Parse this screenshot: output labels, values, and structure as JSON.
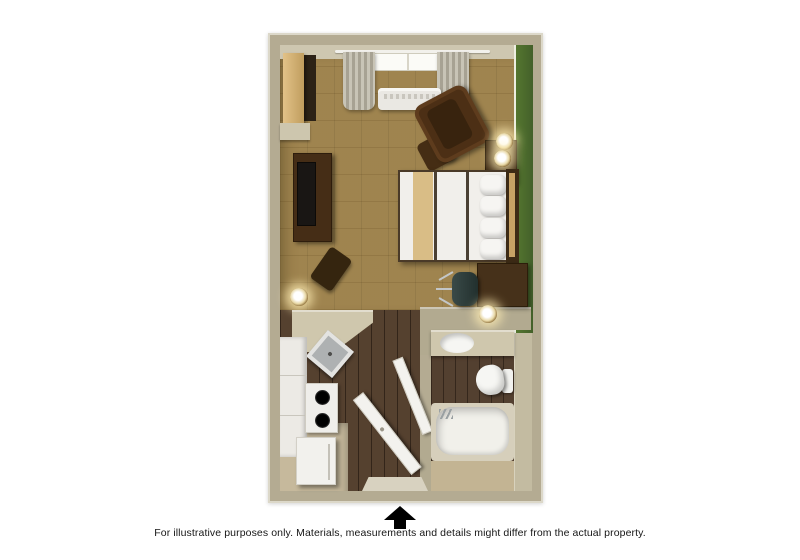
{
  "caption": "For illustrative purposes only.  Materials, measurements and details might differ from the actual property.",
  "floor_plan": {
    "title": "studio suite 3D floor plan",
    "entrance_marker": "up-arrow",
    "rooms": [
      {
        "name": "living-sleeping-area",
        "floor": "tan parquet"
      },
      {
        "name": "kitchen",
        "floor": "dark wood plank"
      },
      {
        "name": "entry-hall",
        "floor": "dark wood plank"
      },
      {
        "name": "bathroom",
        "floor": "dark wood plank with tile strip"
      }
    ],
    "furniture": [
      "closet",
      "curtained-window",
      "ptac-heat-ac-unit",
      "tv-console",
      "television",
      "side-chair",
      "floor-lamp",
      "armchair",
      "ottoman",
      "nightstand",
      "table-lamps",
      "bed-with-accent-runner",
      "pillows",
      "headboard",
      "desk",
      "office-chair",
      "desk-lamp",
      "kitchen-counter",
      "kitchen-sink",
      "stove-cooktop",
      "cabinets",
      "refrigerator",
      "entry-door",
      "bathroom-door",
      "vanity-sink",
      "toilet",
      "bathtub"
    ],
    "colors": {
      "page_background": "#ffffff",
      "wall": "#b4ab92",
      "wall_edge": "#dcd8c9",
      "wall_inner_face": "#cec7b0",
      "accent_wall_green": "#4b692e",
      "parquet_floor": "#9c8049",
      "plank_floor": "#4e3927",
      "entry_tile": "#c6b99c",
      "counter_beige": "#cfc7ad",
      "linen_white": "#f1efeb",
      "bed_stripe_tan": "#d9bd86",
      "furniture_brown": "#4a3018",
      "arrow_black": "#000000"
    }
  }
}
